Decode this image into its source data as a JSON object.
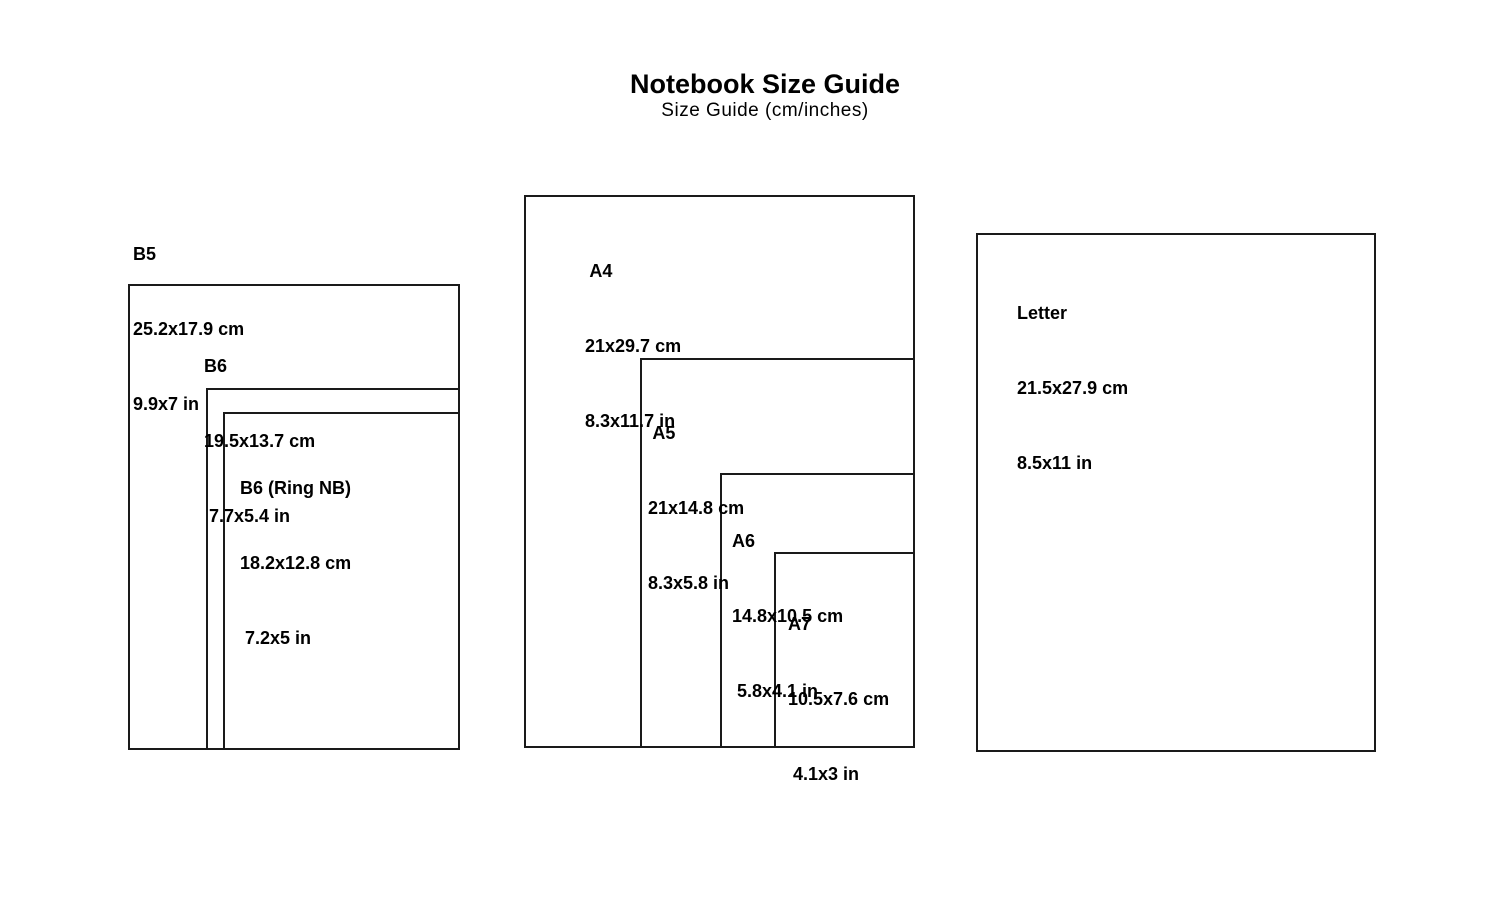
{
  "page": {
    "title": "Notebook Size Guide",
    "subtitle": "Size Guide (cm/inches)"
  },
  "sizes": {
    "b5": {
      "name": "B5",
      "cm": "25.2x17.9 cm",
      "inch": "9.9x7 in"
    },
    "b6": {
      "name": "B6",
      "cm": "19.5x13.7 cm",
      "inch": " 7.7x5.4 in"
    },
    "b6_ring": {
      "name": "B6 (Ring NB)",
      "cm": "18.2x12.8 cm",
      "inch": " 7.2x5 in"
    },
    "a4": {
      "name": " A4",
      "cm": "21x29.7 cm",
      "inch": "8.3x11.7 in"
    },
    "a5": {
      "name": " A5",
      "cm": "21x14.8 cm",
      "inch": "8.3x5.8 in"
    },
    "a6": {
      "name": "A6",
      "cm": "14.8x10.5 cm",
      "inch": " 5.8x4.1 in"
    },
    "a7": {
      "name": "A7",
      "cm": "10.5x7.6 cm",
      "inch": " 4.1x3 in"
    },
    "letter": {
      "name": "Letter",
      "cm": "21.5x27.9 cm",
      "inch": "8.5x11 in"
    }
  },
  "colors": {
    "background": "#ffffff",
    "border": "#1a1a1a",
    "text": "#000000"
  }
}
